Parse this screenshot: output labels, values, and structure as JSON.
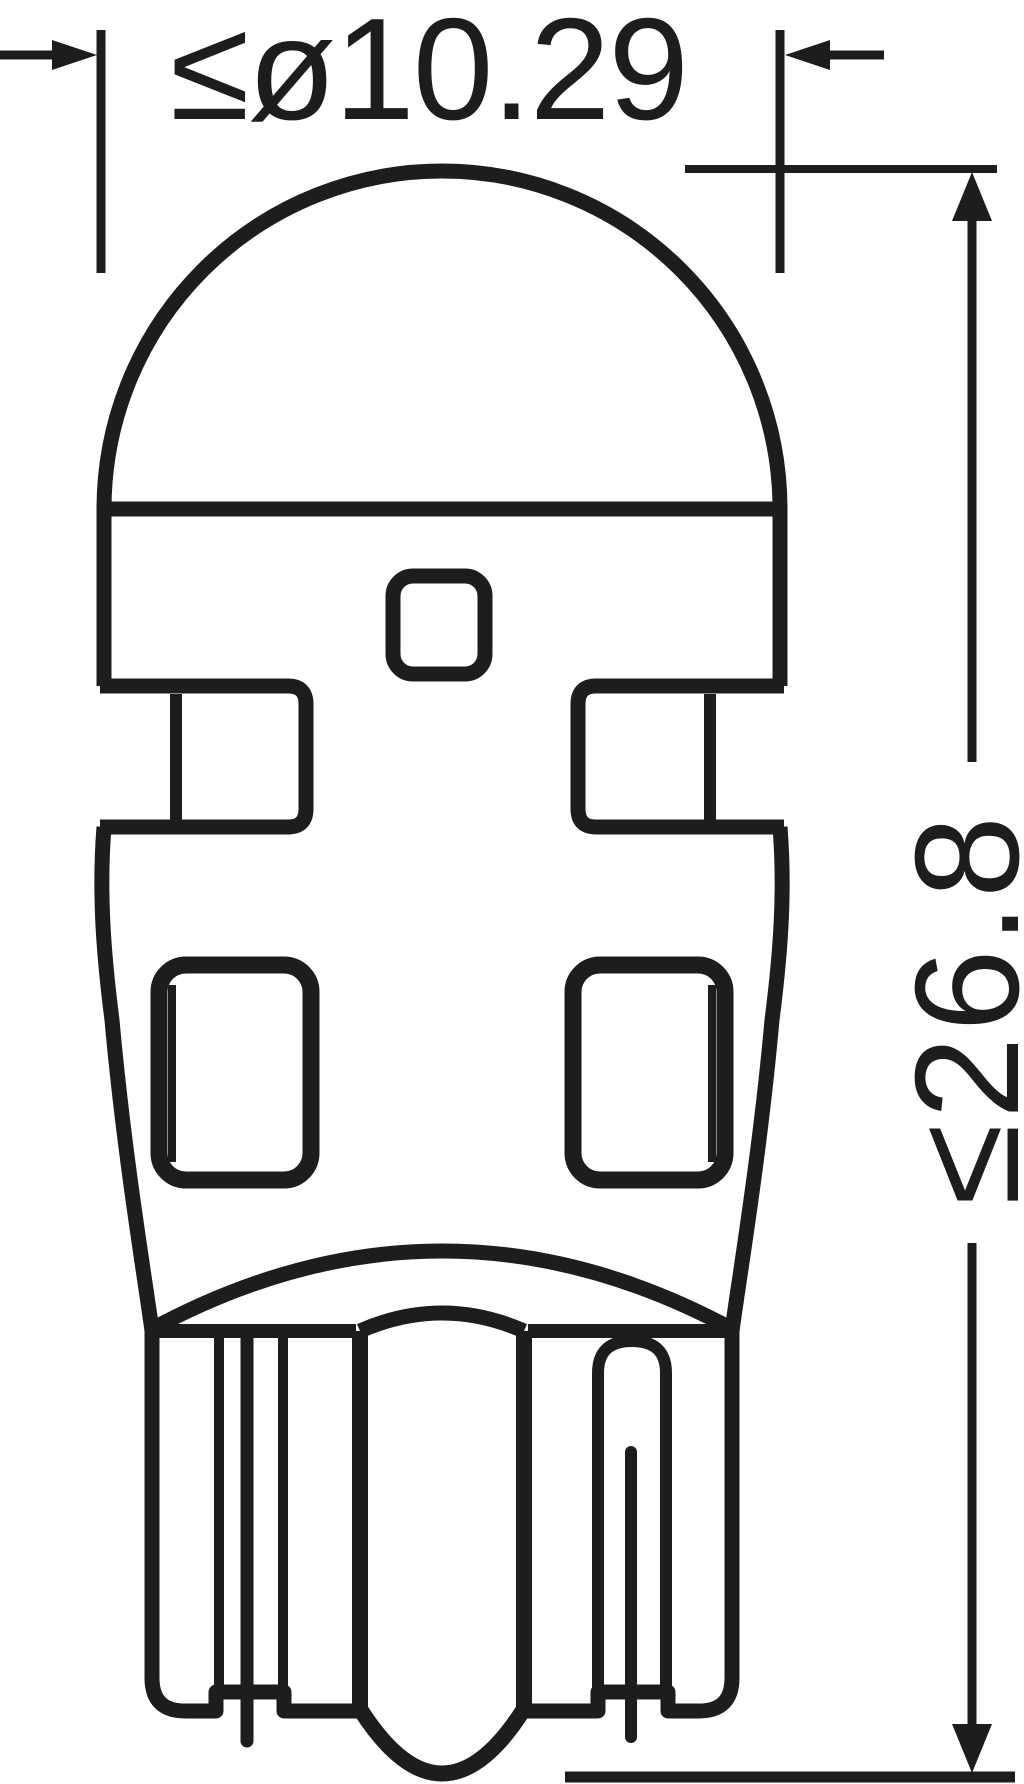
{
  "drawing": {
    "description": "Technical dimension drawing of a wedge-base LED bulb, front view",
    "background_color": "#ffffff",
    "line_color": "#1d1d1b",
    "diameter": {
      "label": "≤ø10.29",
      "value": 10.29,
      "constraint": "max",
      "unit_note": "diameter across widest body section"
    },
    "height": {
      "label": "≤26.8",
      "value": 26.8,
      "constraint": "max",
      "unit_note": "overall length from dome top to base reference line"
    }
  }
}
